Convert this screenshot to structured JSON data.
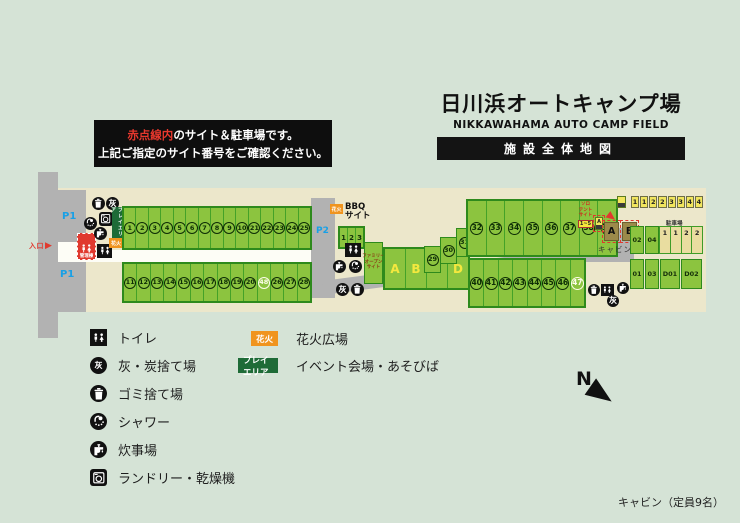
{
  "header": {
    "title": "日川浜オートキャンプ場",
    "subtitle": "NIKKAWAHAMA AUTO CAMP FIELD",
    "banner": "施設全体地図"
  },
  "notice": {
    "highlight": "赤点線内",
    "line1_rest": "のサイト＆駐車場です。",
    "line2": "上記ご指定のサイト番号をご確認ください。",
    "highlight_color": "#e8382d"
  },
  "map": {
    "entrance": "入口",
    "p1a": "P1",
    "p1b": "P1",
    "p2": "P2",
    "p3": "P3",
    "admin": "管理棟",
    "play_area": "プレイエリア",
    "fireworks_small": "花火",
    "row1": [
      "1",
      "2",
      "3",
      "4",
      "5",
      "6",
      "7",
      "8",
      "9",
      "10",
      "21",
      "22",
      "23",
      "24",
      "25"
    ],
    "row2": [
      "11",
      "12",
      "13",
      "14",
      "15",
      "16",
      "17",
      "18",
      "19",
      "20",
      "48",
      "26",
      "27",
      "28"
    ],
    "row3": [
      "32",
      "33",
      "34",
      "35",
      "36",
      "37",
      "38",
      "39"
    ],
    "row4": [
      "40",
      "41",
      "42",
      "43",
      "44",
      "45",
      "46",
      "47"
    ],
    "highlights": [
      "47",
      "48"
    ],
    "bbq_line1": "BBQ",
    "bbq_line2": "サイト",
    "bbq_sites": [
      "1",
      "2",
      "3"
    ],
    "family_lines": [
      "ファミリー",
      "オープン",
      "サイト"
    ],
    "family_sites": [
      "A",
      "B",
      "C",
      "D"
    ],
    "mid_sites": [
      "29",
      "30",
      "31"
    ],
    "solo_lines": [
      "ソロ",
      "テント",
      "サイト"
    ],
    "solo_range": "1~5",
    "mini_a": "A",
    "cabin_a": "A",
    "cabin_b": "B",
    "cabin_caption": "キャビン",
    "slot_row": [
      "1",
      "1",
      "2",
      "2",
      "3",
      "3",
      "4",
      "4"
    ],
    "parking_label": "駐車場",
    "parking_slots": [
      "1",
      "1",
      "2",
      "2"
    ],
    "plots": [
      "02",
      "04",
      "01",
      "03",
      "D01",
      "D02"
    ]
  },
  "legend": {
    "items": [
      {
        "icon": "toilet-icon",
        "label": "トイレ"
      },
      {
        "icon": "ash-icon",
        "label": "灰・炭捨て場"
      },
      {
        "icon": "trash-icon",
        "label": "ゴミ捨て場"
      },
      {
        "icon": "shower-icon",
        "label": "シャワー"
      },
      {
        "icon": "faucet-icon",
        "label": "炊事場"
      },
      {
        "icon": "laundry-icon",
        "label": "ランドリー・乾燥機"
      }
    ]
  },
  "legend2": {
    "items": [
      {
        "badge": "花火",
        "color": "#f0941e",
        "label": "花火広場"
      },
      {
        "badge": "プレイエリア",
        "color": "#1e6b37",
        "label": "イベント会場・あそびば"
      }
    ]
  },
  "compass": "N",
  "footer": "キャビン（定員9名）",
  "colors": {
    "background": "#d5e3d6",
    "ground": "#ece7cb",
    "road": "#b2b2b2",
    "site_green": "#8cc43f",
    "site_border": "#2e8a1c",
    "accent_red": "#e0392e",
    "accent_orange": "#f0941e",
    "parking_blue": "#19a0e6"
  }
}
